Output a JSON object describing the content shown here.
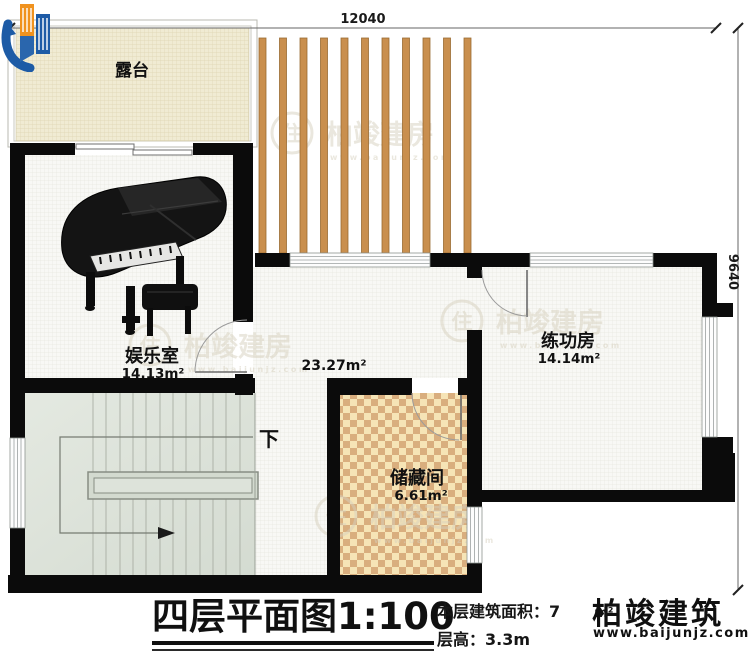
{
  "header": {
    "dim_top": "12040",
    "dim_right": "9640"
  },
  "rooms": {
    "terrace": {
      "name": "露台"
    },
    "entertainment": {
      "name": "娱乐室",
      "area": "14.13m²"
    },
    "hall": {
      "area": "23.27m²"
    },
    "practice": {
      "name": "练功房",
      "area": "14.14m²"
    },
    "storage": {
      "name": "储藏间",
      "area": "6.61m²"
    },
    "stairs": {
      "direction": "下"
    }
  },
  "titleblock": {
    "title": "四层平面图1:100",
    "area_label": "本层建筑面积：",
    "area_value": "7",
    "area_unit": "m²",
    "floor_height": "层高：3.3m"
  },
  "branding": {
    "company": "柏竣建筑",
    "website": "www.baijunjz.com",
    "watermark": {
      "badge": "住",
      "text": "柏竣建房",
      "url": "www.baijunjz.com"
    },
    "colors": {
      "blue": "#1d5ba6",
      "orange": "#f0921e",
      "wood": "#c98f4e"
    }
  }
}
